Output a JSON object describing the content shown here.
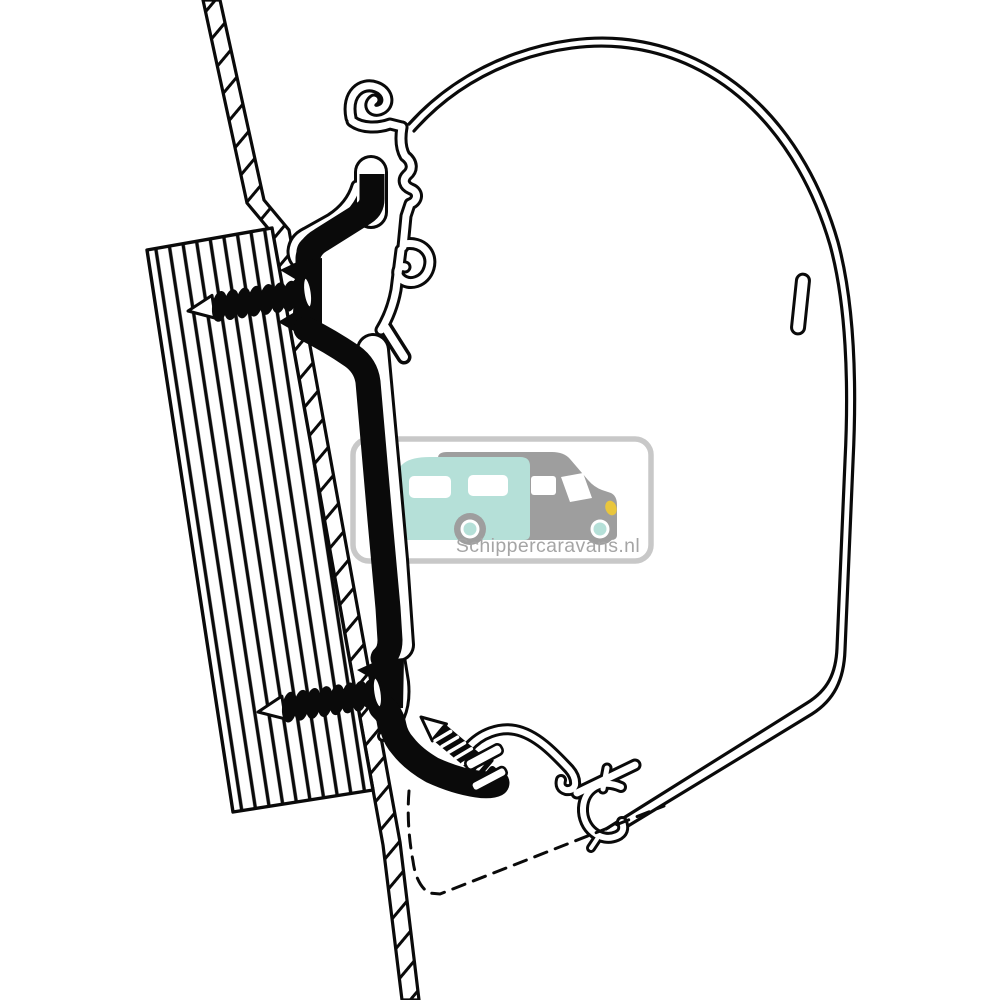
{
  "watermark": {
    "text": "Schippercaravans.nl"
  },
  "colors": {
    "line": "#0a0a0a",
    "background": "#ffffff",
    "watermark_border": "#c8c8c8",
    "watermark_gray": "#9e9e9e",
    "watermark_teal": "#b5e0d8",
    "watermark_text": "#a5a5a5",
    "headlight_yellow": "#e9c63d"
  }
}
